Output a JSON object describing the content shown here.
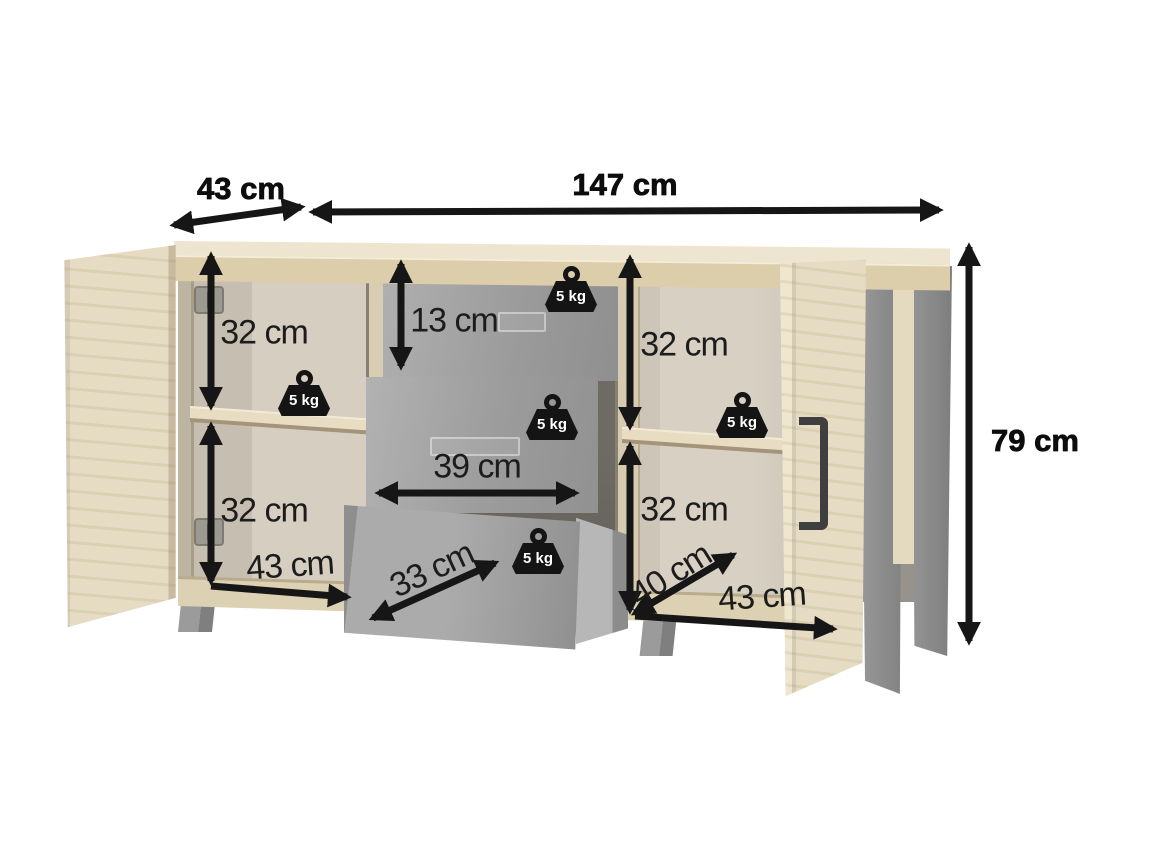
{
  "diagram": {
    "dimensions": {
      "top_depth": "43 cm",
      "width": "147 cm",
      "height": "79 cm",
      "left_upper_section": "32 cm",
      "left_lower_section": "32 cm",
      "drawer_height": "13 cm",
      "drawer_width": "39 cm",
      "drawer_depth": "33 cm",
      "left_inner_depth": "43 cm",
      "right_upper_section": "32 cm",
      "right_lower_section": "32 cm",
      "right_inner_depth": "40 cm",
      "right_inner_width": "43 cm"
    },
    "weight_labels": [
      "5 kg",
      "5 kg",
      "5 kg",
      "5 kg",
      "5 kg"
    ],
    "colors": {
      "arrow": "#161616",
      "wood_light": "#ece3ce",
      "wood_front": "#dccdab",
      "interior": "#d6cec0",
      "drawer_grey": "#a4a4a4",
      "metal_grey": "#8f8f8f",
      "label_text": "#1c1c1c",
      "background": "#ffffff"
    }
  }
}
